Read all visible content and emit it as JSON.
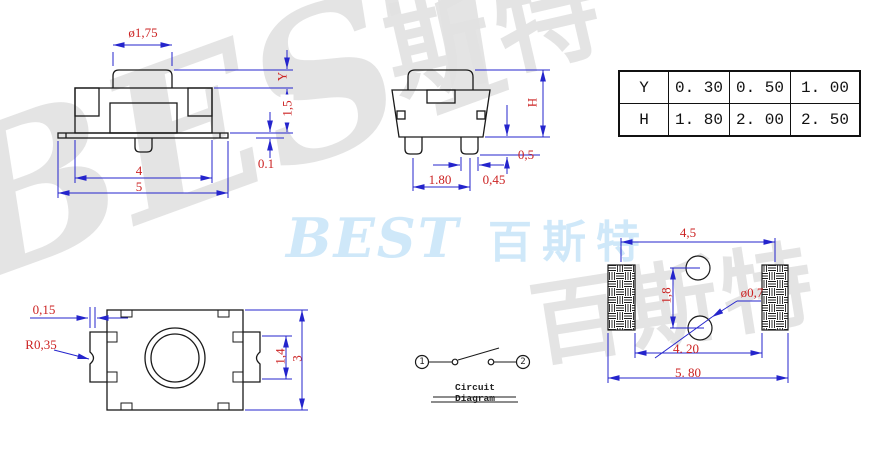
{
  "watermarks": {
    "brand_latin": "BEST",
    "brand_cjk": "百斯特",
    "gray_left": "BEST",
    "gray_top": "斯特",
    "gray_bottom_right": "百斯特"
  },
  "front_view": {
    "button_dia_label": "ø1,75",
    "travel_label": "Y",
    "body_height_label": "1,5",
    "plate_thickness_label": "0.1",
    "body_width_label": "4",
    "total_width_label": "5"
  },
  "side_view": {
    "height_label": "H",
    "leg_height_label": "0,5",
    "leg_pitch_label": "1.80",
    "leg_width_label": "0,45"
  },
  "spec_table": {
    "rows": [
      {
        "param": "Y",
        "v1": "0. 30",
        "v2": "0. 50",
        "v3": "1. 00"
      },
      {
        "param": "H",
        "v1": "1. 80",
        "v2": "2. 00",
        "v3": "2. 50"
      }
    ]
  },
  "top_view": {
    "gap_label": "0,15",
    "radius_label": "R0,35",
    "tab_height_label": "1,4",
    "body_height_label": "3"
  },
  "circuit": {
    "terminal_1": "1",
    "terminal_2": "2",
    "caption": "Circuit Diagram"
  },
  "footprint": {
    "pad_pitch_label": "4,5",
    "hole_pitch_label": "1,8",
    "hole_dia_label": "ø0,7",
    "inner_span_label": "4. 20",
    "outer_span_label": "5. 80"
  },
  "colors": {
    "dimension_blue": "#2424cc",
    "dimension_red": "#cc2323",
    "outline_black": "#1a1a1a",
    "watermark_blue": "#cfe8f9",
    "watermark_gray": "#e2e2e2"
  }
}
